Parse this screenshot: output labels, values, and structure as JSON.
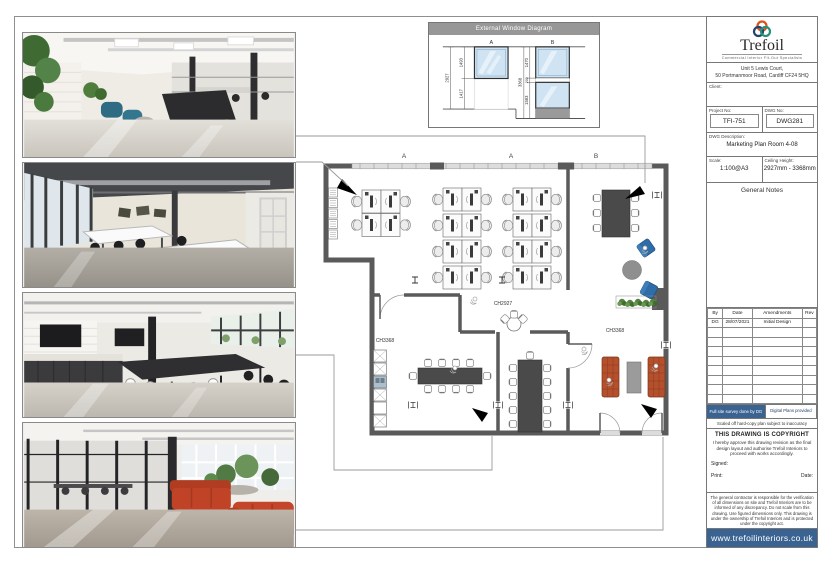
{
  "window_diagram": {
    "title": "External Window Diagram",
    "windows": [
      {
        "label": "A",
        "total": "2927",
        "segments": [
          "1493",
          "1417"
        ]
      },
      {
        "label": "B",
        "total": "3368",
        "segments": [
          "1470",
          "200",
          "1583"
        ]
      }
    ]
  },
  "plan": {
    "grid_markers": [
      "A",
      "A",
      "B"
    ],
    "room_labels": [
      "CH2927",
      "CH3368",
      "CH3368"
    ]
  },
  "title_block": {
    "brand": {
      "name": "Trefoil",
      "tagline": "Commercial Interior Fit-Out Specialists"
    },
    "address_line1": "Unit 5 Lewis Court,",
    "address_line2": "50 Portmanmoor Road, Cardiff CF24 5HQ",
    "client_label": "Client:",
    "project_no_label": "Project No:",
    "project_no": "TFI-751",
    "dwg_no_label": "DWG No:",
    "dwg_no": "DWG281",
    "dwg_desc_label": "DWG Description:",
    "dwg_desc": "Marketing Plan Room 4-08",
    "scale_label": "Scale:",
    "scale": "1:100@A3",
    "ceiling_label": "Ceiling Height:",
    "ceiling_height": "2927mm - 3368mm",
    "general_notes_label": "General Notes",
    "amendments": {
      "headers": [
        "By",
        "Date",
        "Amendments",
        "Rev"
      ],
      "rows": [
        [
          "DG",
          "28/07/2021",
          "Initial Design",
          ""
        ]
      ],
      "empty_rows": 8
    },
    "survey_tag": "Full site survey done by DG",
    "digital_tag": "Digital Plans provided",
    "scaled_note": "Scaled off hard-copy plan subject to inaccuracy",
    "copyright_heading": "THIS DRAWING IS COPYRIGHT",
    "approval_text": "I hereby approve this drawing revision as the final design layout and authorise Trefoil Interiors to proceed with works accordingly.",
    "signed_label": "Signed:",
    "print_label": "Print:",
    "date_label": "Date:",
    "disclaimer": "The general contractor is responsible for the verification of all dimensions on site and Trefoil Interiors are to be informed of any discrepancy. Do not scale from this drawing. Use figured dimensions only. This drawing is under the ownership of Trefoil Interiors and is protected under the copyright act.",
    "website": "www.trefoilinteriors.co.uk"
  },
  "colors": {
    "accent_blue": "#3a6391",
    "wall": "#5a5a5a",
    "sofa_orange": "#b5502c",
    "chair_blue": "#2f6da8"
  }
}
